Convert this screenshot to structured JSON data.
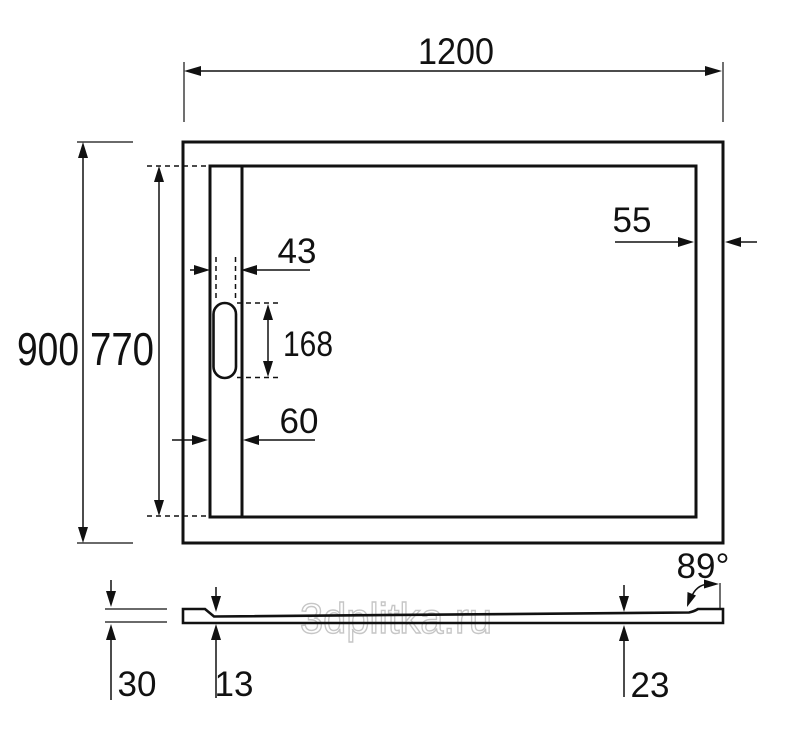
{
  "colors": {
    "line": "#111111",
    "watermark_outline": "#c6c6c6",
    "background": "#ffffff"
  },
  "watermark": {
    "text": "3dplitka.ru"
  },
  "plan_view": {
    "overall_width": "1200",
    "overall_depth": "900",
    "inner_depth": "770",
    "slot_width": "43",
    "slot_length": "168",
    "channel_width": "60",
    "rim_width": "55"
  },
  "section_view": {
    "edge_height": "30",
    "drain_thickness": "13",
    "rim_thickness": "23",
    "side_angle": "89°"
  }
}
